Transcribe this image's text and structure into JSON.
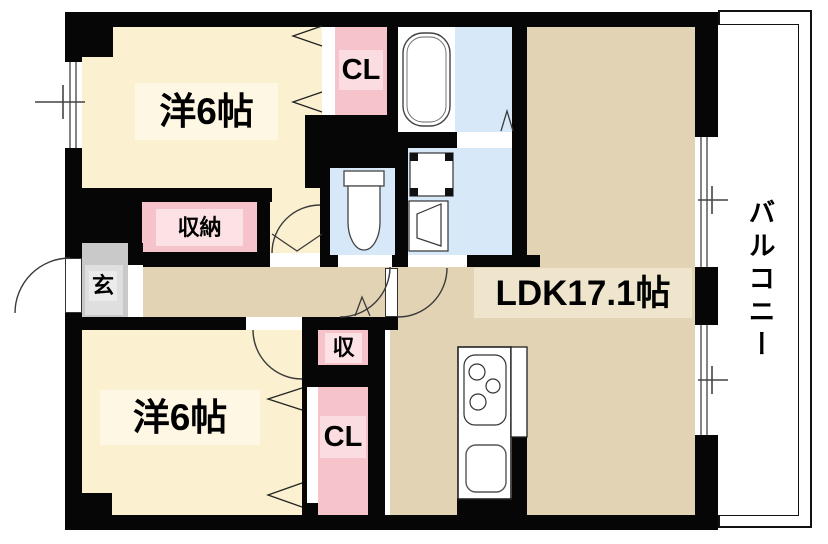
{
  "plan": {
    "rooms": {
      "bedroom_top": {
        "label": "洋6帖"
      },
      "bedroom_bottom": {
        "label": "洋6帖"
      },
      "ldk": {
        "label": "LDK17.1帖"
      },
      "closet_top": {
        "label": "CL"
      },
      "closet_bottom": {
        "label": "CL"
      },
      "storage": {
        "label": "収納"
      },
      "storage_small": {
        "label": "収"
      },
      "entrance": {
        "label": "玄"
      },
      "balcony": {
        "label": "バルコニー"
      }
    },
    "fixtures": [
      "bathtub",
      "toilet",
      "washing-machine-pan",
      "washbasin",
      "kitchen-stove",
      "kitchen-sink"
    ],
    "colors": {
      "wall": "#060606",
      "bedroom_floor": "#FBF0D0",
      "ldk_floor": "#E3D3B5",
      "closet_floor": "#F7C3CA",
      "wet_area_floor": "#D7E8F8",
      "entrance_floor": "#C9C9C9",
      "balcony": "#FFFFFF"
    }
  }
}
